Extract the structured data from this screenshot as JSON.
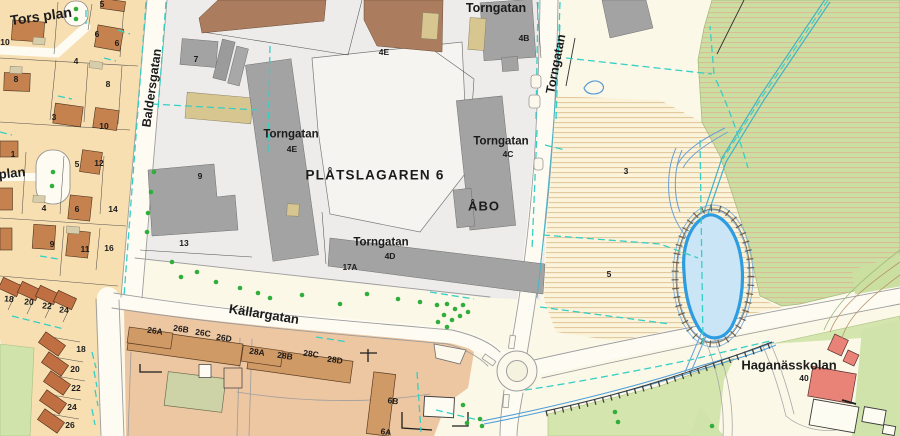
{
  "map": {
    "title": "Municipal base map with cadastral parcels",
    "labels": [
      {
        "t": "Tors plan",
        "x": 41,
        "y": 16,
        "r": -8,
        "s": 14,
        "cls": "street"
      },
      {
        "t": "plan",
        "x": 12,
        "y": 173,
        "r": -6,
        "s": 13,
        "cls": "street"
      },
      {
        "t": "Baldersgatan",
        "x": 152,
        "y": 88,
        "r": -82,
        "s": 12.5,
        "cls": "street"
      },
      {
        "t": "Torngatan",
        "x": 496,
        "y": 8,
        "r": 0,
        "s": 12.5,
        "cls": "street"
      },
      {
        "t": "Torngatan",
        "x": 556,
        "y": 64,
        "r": -79,
        "s": 12.5,
        "cls": "street"
      },
      {
        "t": "Källargatan",
        "x": 264,
        "y": 314,
        "r": 9,
        "s": 13,
        "cls": "street"
      },
      {
        "t": "PLÅTSLAGAREN 6",
        "x": 375,
        "y": 175,
        "r": 0,
        "s": 13.5,
        "ls": 1.2,
        "cls": "parcel-name"
      },
      {
        "t": "ÅBO",
        "x": 484,
        "y": 206,
        "r": 0,
        "s": 13,
        "ls": 1,
        "cls": "parcel-name"
      },
      {
        "t": "Haganässkolan",
        "x": 789,
        "y": 365,
        "r": 0,
        "s": 13,
        "cls": "place"
      },
      {
        "t": "Torngatan",
        "x": 291,
        "y": 135,
        "r": 0,
        "s": 11.5,
        "cls": "address"
      },
      {
        "t": "4E",
        "x": 292,
        "y": 149,
        "r": 0,
        "s": 8.5,
        "cls": "address"
      },
      {
        "t": "Torngatan",
        "x": 501,
        "y": 142,
        "r": 0,
        "s": 11.5,
        "cls": "address"
      },
      {
        "t": "4C",
        "x": 508,
        "y": 154,
        "r": 0,
        "s": 8.5,
        "cls": "address"
      },
      {
        "t": "Torngatan",
        "x": 381,
        "y": 243,
        "r": 0,
        "s": 11.5,
        "cls": "address"
      },
      {
        "t": "4D",
        "x": 390,
        "y": 256,
        "r": 0,
        "s": 8.5,
        "cls": "address"
      },
      {
        "t": "4B",
        "x": 524,
        "y": 38,
        "r": 0,
        "s": 8.5,
        "cls": "address"
      },
      {
        "t": "4E",
        "x": 384,
        "y": 52,
        "r": 0,
        "s": 8.5,
        "cls": "address"
      },
      {
        "t": "17A",
        "x": 350,
        "y": 268,
        "r": 0,
        "s": 8,
        "cls": "address"
      },
      {
        "t": "40",
        "x": 804,
        "y": 378,
        "r": 0,
        "s": 8.5,
        "cls": "address"
      },
      {
        "t": "6B",
        "x": 393,
        "y": 401,
        "r": 8,
        "s": 8.5,
        "cls": "address"
      },
      {
        "t": "6A",
        "x": 386,
        "y": 432,
        "r": 8,
        "s": 8.5,
        "cls": "address"
      },
      {
        "t": "26A",
        "x": 155,
        "y": 331,
        "r": 8,
        "s": 8.5,
        "cls": "address"
      },
      {
        "t": "26B",
        "x": 181,
        "y": 329,
        "r": 8,
        "s": 8.5,
        "cls": "address"
      },
      {
        "t": "26C",
        "x": 203,
        "y": 333,
        "r": 8,
        "s": 8.5,
        "cls": "address"
      },
      {
        "t": "26D",
        "x": 224,
        "y": 338,
        "r": 8,
        "s": 8.5,
        "cls": "address"
      },
      {
        "t": "28A",
        "x": 257,
        "y": 352,
        "r": 8,
        "s": 8.5,
        "cls": "address"
      },
      {
        "t": "28B",
        "x": 285,
        "y": 356,
        "r": 8,
        "s": 8.5,
        "cls": "address"
      },
      {
        "t": "28C",
        "x": 311,
        "y": 354,
        "r": 8,
        "s": 8.5,
        "cls": "address"
      },
      {
        "t": "28D",
        "x": 335,
        "y": 360,
        "r": 8,
        "s": 8.5,
        "cls": "address"
      },
      {
        "t": "5",
        "x": 102,
        "y": 4,
        "r": 0,
        "s": 8.5,
        "cls": "plot-number"
      },
      {
        "t": "6",
        "x": 97,
        "y": 34,
        "r": 0,
        "s": 8.5,
        "cls": "plot-number"
      },
      {
        "t": "6",
        "x": 117,
        "y": 43,
        "r": 0,
        "s": 8.5,
        "cls": "plot-number"
      },
      {
        "t": "10",
        "x": 5,
        "y": 42,
        "r": 0,
        "s": 8.5,
        "cls": "plot-number"
      },
      {
        "t": "4",
        "x": 76,
        "y": 61,
        "r": 0,
        "s": 8.5,
        "cls": "plot-number"
      },
      {
        "t": "8",
        "x": 16,
        "y": 79,
        "r": 0,
        "s": 8.5,
        "cls": "plot-number"
      },
      {
        "t": "8",
        "x": 108,
        "y": 84,
        "r": 0,
        "s": 8.5,
        "cls": "plot-number"
      },
      {
        "t": "3",
        "x": 54,
        "y": 117,
        "r": 0,
        "s": 8.5,
        "cls": "plot-number"
      },
      {
        "t": "10",
        "x": 104,
        "y": 126,
        "r": 0,
        "s": 8.5,
        "cls": "plot-number"
      },
      {
        "t": "1",
        "x": 13,
        "y": 154,
        "r": 0,
        "s": 8.5,
        "cls": "plot-number"
      },
      {
        "t": "5",
        "x": 77,
        "y": 164,
        "r": 0,
        "s": 8.5,
        "cls": "plot-number"
      },
      {
        "t": "12",
        "x": 99,
        "y": 163,
        "r": 0,
        "s": 8.5,
        "cls": "plot-number"
      },
      {
        "t": "4",
        "x": 44,
        "y": 208,
        "r": 0,
        "s": 8.5,
        "cls": "plot-number"
      },
      {
        "t": "6",
        "x": 77,
        "y": 209,
        "r": 0,
        "s": 8.5,
        "cls": "plot-number"
      },
      {
        "t": "14",
        "x": 113,
        "y": 209,
        "r": 0,
        "s": 8.5,
        "cls": "plot-number"
      },
      {
        "t": "9",
        "x": 52,
        "y": 244,
        "r": 0,
        "s": 8.5,
        "cls": "plot-number"
      },
      {
        "t": "11",
        "x": 85,
        "y": 249,
        "r": 0,
        "s": 8.5,
        "cls": "plot-number"
      },
      {
        "t": "16",
        "x": 109,
        "y": 248,
        "r": 0,
        "s": 8.5,
        "cls": "plot-number"
      },
      {
        "t": "7",
        "x": 196,
        "y": 59,
        "r": 0,
        "s": 8.5,
        "cls": "plot-number"
      },
      {
        "t": "9",
        "x": 200,
        "y": 176,
        "r": 0,
        "s": 8.5,
        "cls": "plot-number"
      },
      {
        "t": "13",
        "x": 184,
        "y": 243,
        "r": 0,
        "s": 8.5,
        "cls": "plot-number"
      },
      {
        "t": "3",
        "x": 626,
        "y": 171,
        "r": 0,
        "s": 8.5,
        "cls": "plot-number"
      },
      {
        "t": "5",
        "x": 609,
        "y": 274,
        "r": 0,
        "s": 8.5,
        "cls": "plot-number"
      },
      {
        "t": "18",
        "x": 9,
        "y": 299,
        "r": 5,
        "s": 8.5,
        "cls": "plot-number"
      },
      {
        "t": "20",
        "x": 29,
        "y": 302,
        "r": 5,
        "s": 8.5,
        "cls": "plot-number"
      },
      {
        "t": "22",
        "x": 47,
        "y": 306,
        "r": 5,
        "s": 8.5,
        "cls": "plot-number"
      },
      {
        "t": "24",
        "x": 64,
        "y": 310,
        "r": 5,
        "s": 8.5,
        "cls": "plot-number"
      },
      {
        "t": "18",
        "x": 81,
        "y": 349,
        "r": 0,
        "s": 8.5,
        "cls": "plot-number"
      },
      {
        "t": "20",
        "x": 75,
        "y": 369,
        "r": 0,
        "s": 8.5,
        "cls": "plot-number"
      },
      {
        "t": "22",
        "x": 76,
        "y": 388,
        "r": 0,
        "s": 8.5,
        "cls": "plot-number"
      },
      {
        "t": "24",
        "x": 72,
        "y": 407,
        "r": 0,
        "s": 8.5,
        "cls": "plot-number"
      },
      {
        "t": "26",
        "x": 70,
        "y": 425,
        "r": 0,
        "s": 8.5,
        "cls": "plot-number"
      }
    ],
    "icons": {
      "tree-icon": "small green dot",
      "pond-icon": "blue water body with slope hatch ring",
      "roundabout-icon": "double circle road junction"
    },
    "colors": {
      "base_cream": "#fcf8e8",
      "road_fill": "#fdfbf2",
      "residential_plot_tan": "#f7dfb2",
      "house_orange": "#c5824f",
      "rowhouse_red": "#c06f42",
      "industrial_gray_bg": "#edecea",
      "building_gray": "#a3a3a3",
      "building_brown": "#ab7d5e",
      "apartment_area_salmon": "#edc6a2",
      "apartment_building": "#d09a66",
      "school_red": "#ea8377",
      "green_area": "#cfe3ab",
      "field_hatch_line": "#e3c99e",
      "pond_fill": "#c9e5f6",
      "pond_stroke": "#2d9ce0",
      "stream_teal": "#44b2c6",
      "boundary_dashed_cyan": "#35cfc4"
    }
  }
}
